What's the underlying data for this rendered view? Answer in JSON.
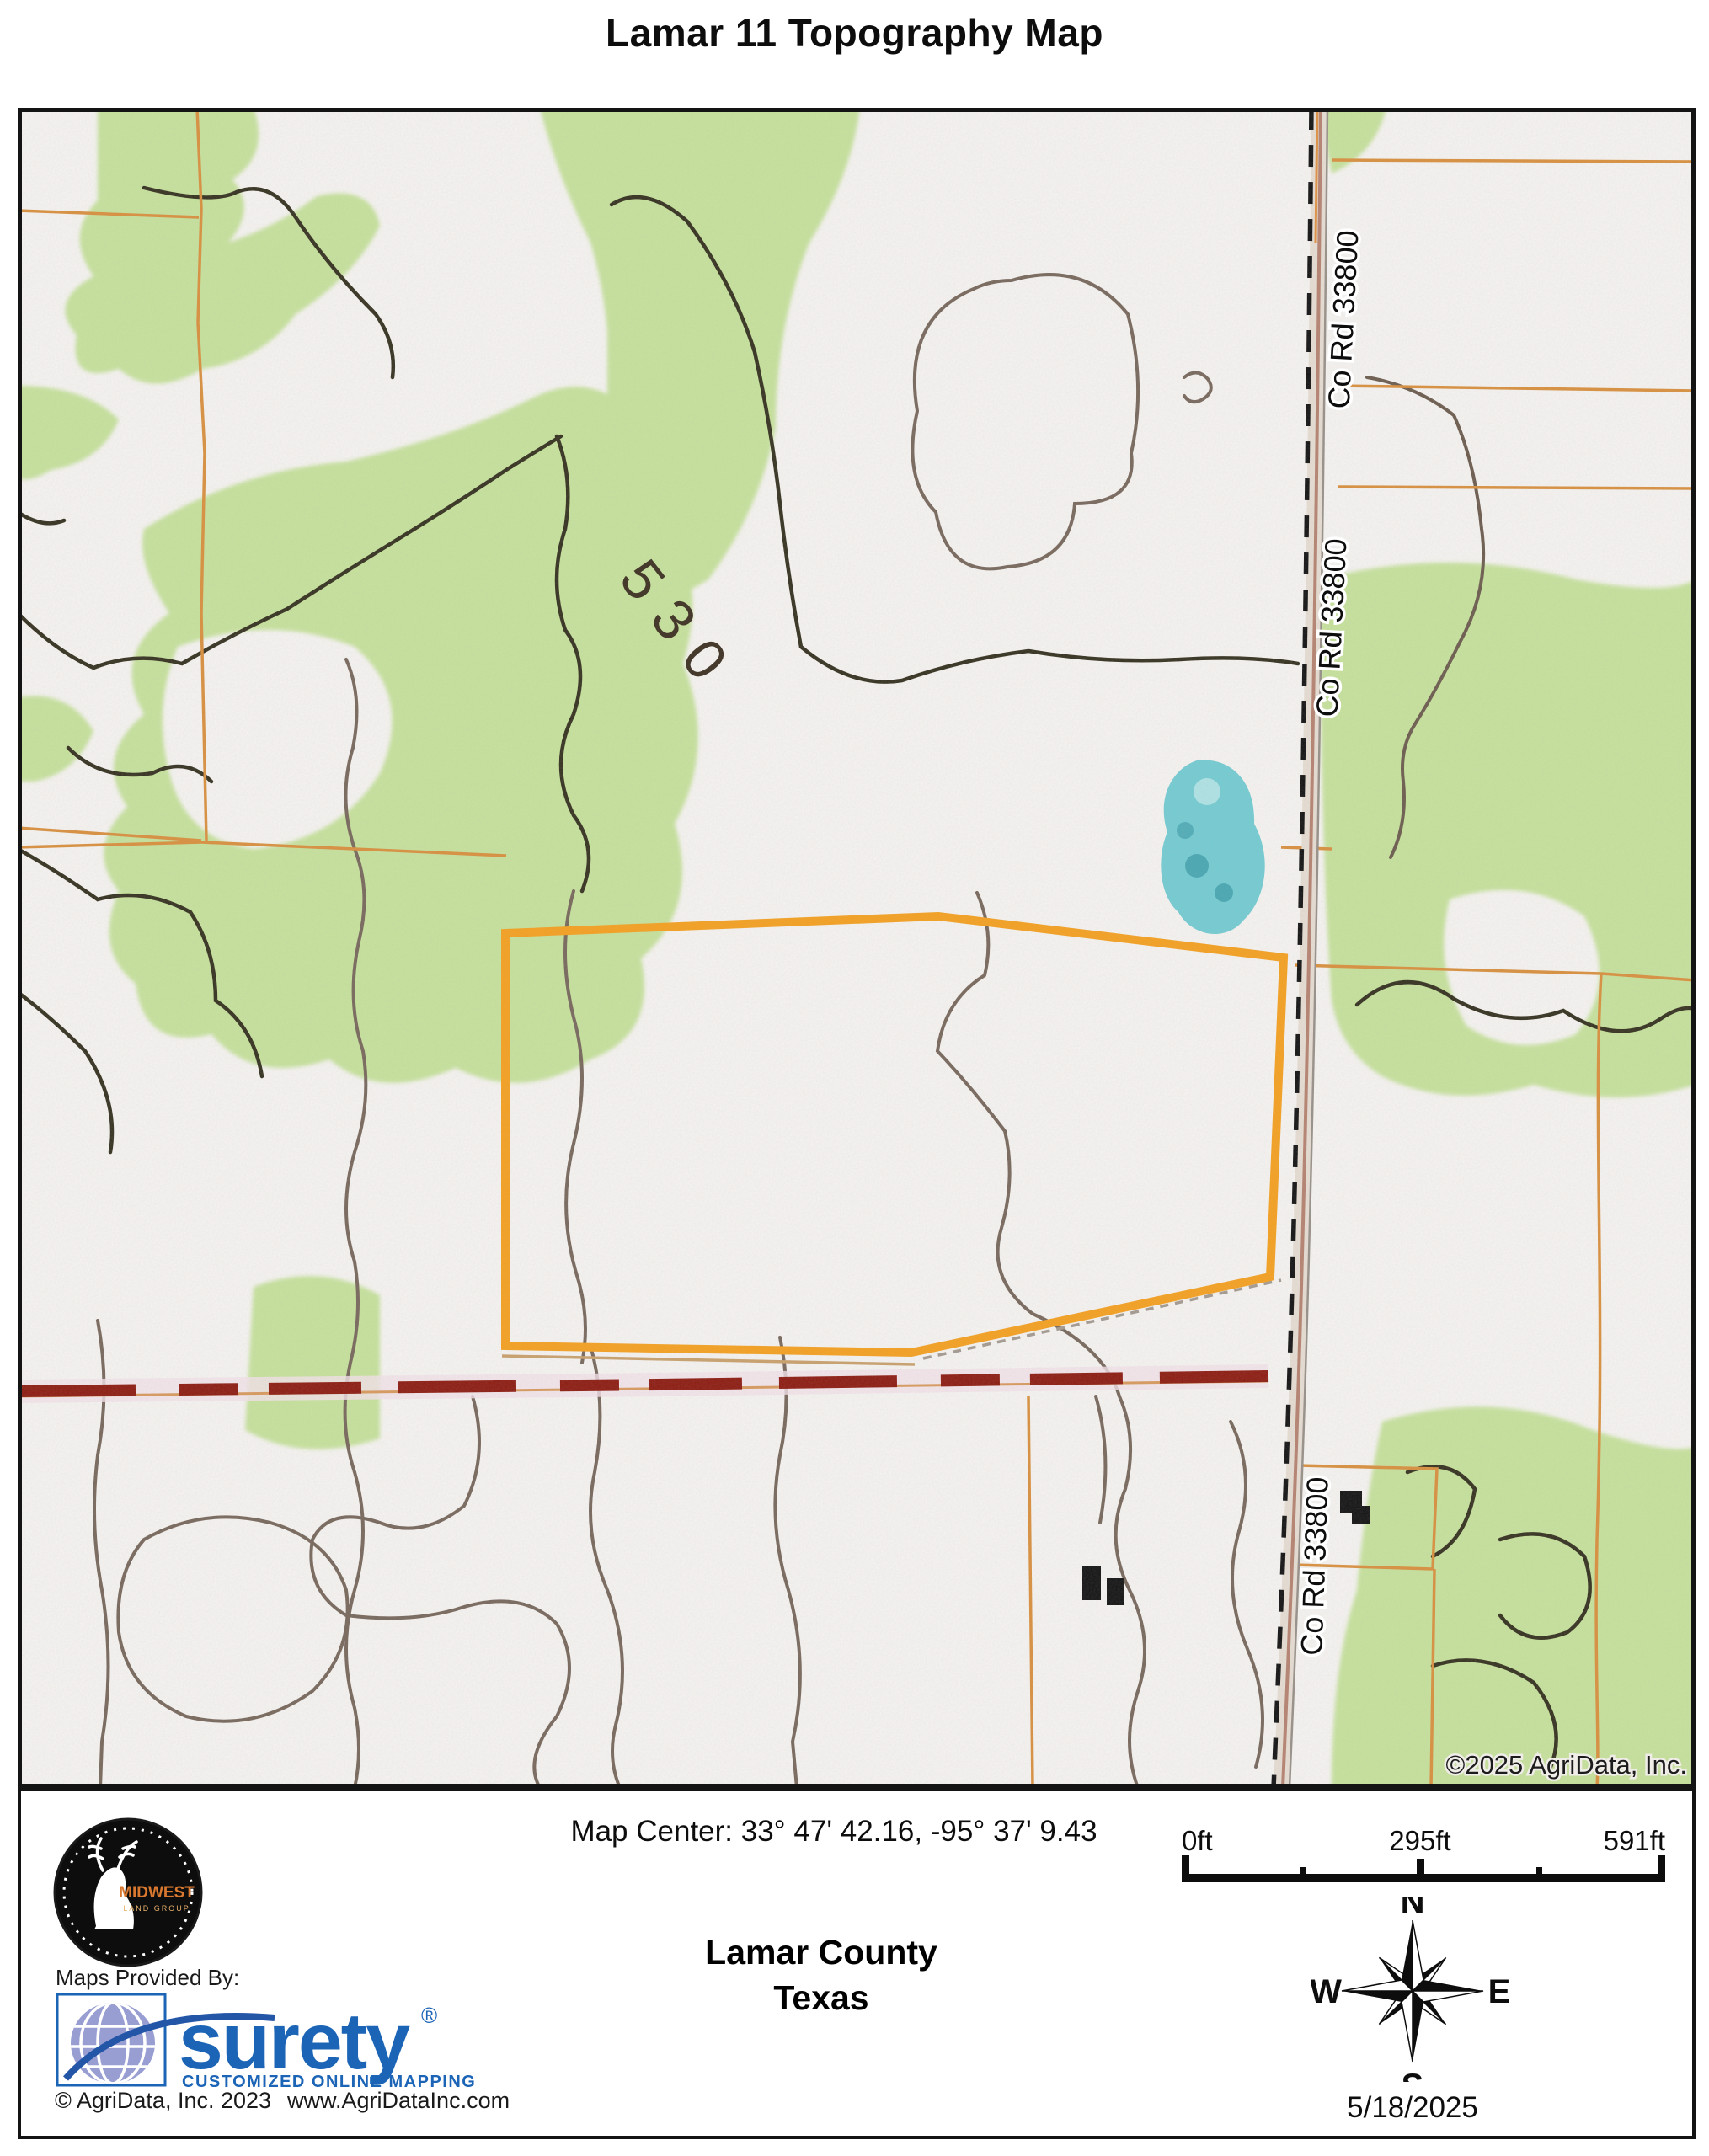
{
  "title": "Lamar 11 Topography Map",
  "map": {
    "contour_label": "530",
    "road_label": "Co Rd 33800",
    "copyright": "©2025 AgriData, Inc.",
    "colors": {
      "highlight_parcel": "#F5A01E",
      "parcel_lines": "#D98F3C",
      "vegetation": "#C6E29B",
      "water": "#72CCD2",
      "section_line_red": "#8C1A0F"
    }
  },
  "footer": {
    "map_center": "Map Center: 33° 47' 42.16,  -95° 37' 9.43",
    "provided_by": "Maps Provided By:",
    "midwest_logo": {
      "name": "MIDWEST",
      "subtitle": "LAND GROUP"
    },
    "surety_logo": {
      "name": "surety",
      "registered": "®",
      "tagline": "CUSTOMIZED ONLINE MAPPING"
    },
    "agridata_copyright": "© AgriData, Inc. 2023",
    "agridata_url": "www.AgriDataInc.com",
    "county": "Lamar County",
    "state": "Texas",
    "scale_bar": {
      "start": "0ft",
      "middle": "295ft",
      "end": "591ft"
    },
    "compass": {
      "north": "N",
      "east": "E",
      "south": "S",
      "west": "W"
    },
    "date": "5/18/2025"
  }
}
